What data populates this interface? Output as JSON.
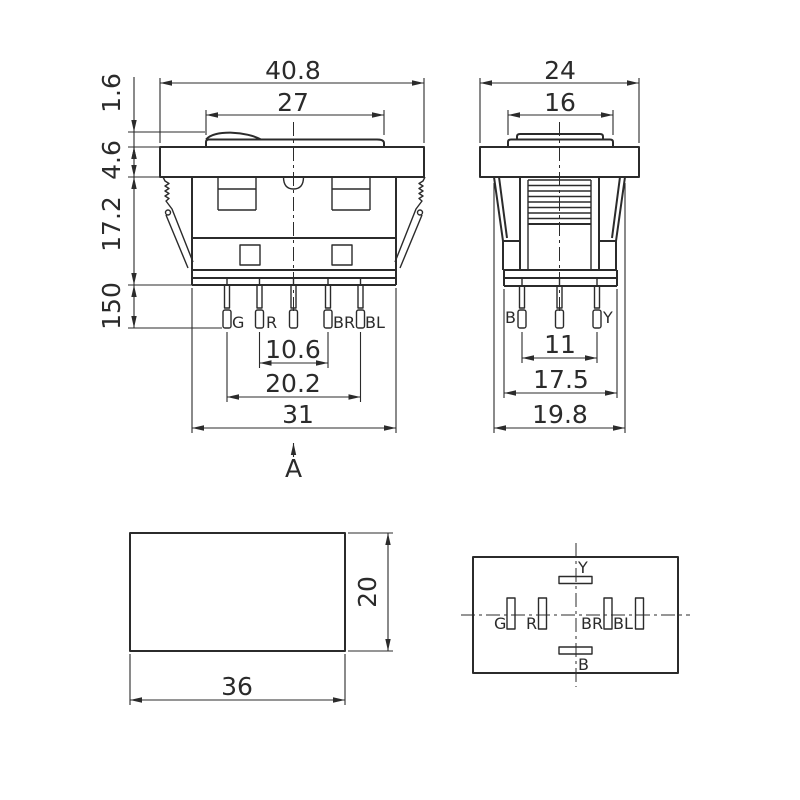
{
  "colors": {
    "line": "#2b2b2b",
    "background": "#ffffff"
  },
  "front_view": {
    "dims": {
      "overall_width": "40.8",
      "button_width": "27",
      "button_height": "1.6",
      "bezel_height": "4.6",
      "body_height": "17.2",
      "pin_length": "150",
      "pin_pitch_inner": "10.6",
      "pin_pitch_outer": "20.2",
      "body_width": "31"
    },
    "section_label": "A",
    "pins": [
      "G",
      "R",
      "BR",
      "BL"
    ]
  },
  "side_view": {
    "dims": {
      "overall_width": "24",
      "button_width": "16",
      "pin_pitch": "11",
      "base_width": "17.5",
      "body_width": "19.8"
    },
    "pins": [
      "B",
      "Y"
    ]
  },
  "cutout_view": {
    "dims": {
      "width": "36",
      "height": "20"
    }
  },
  "bottom_view": {
    "terminals": [
      "Y",
      "G",
      "R",
      "BR",
      "BL",
      "B"
    ]
  }
}
